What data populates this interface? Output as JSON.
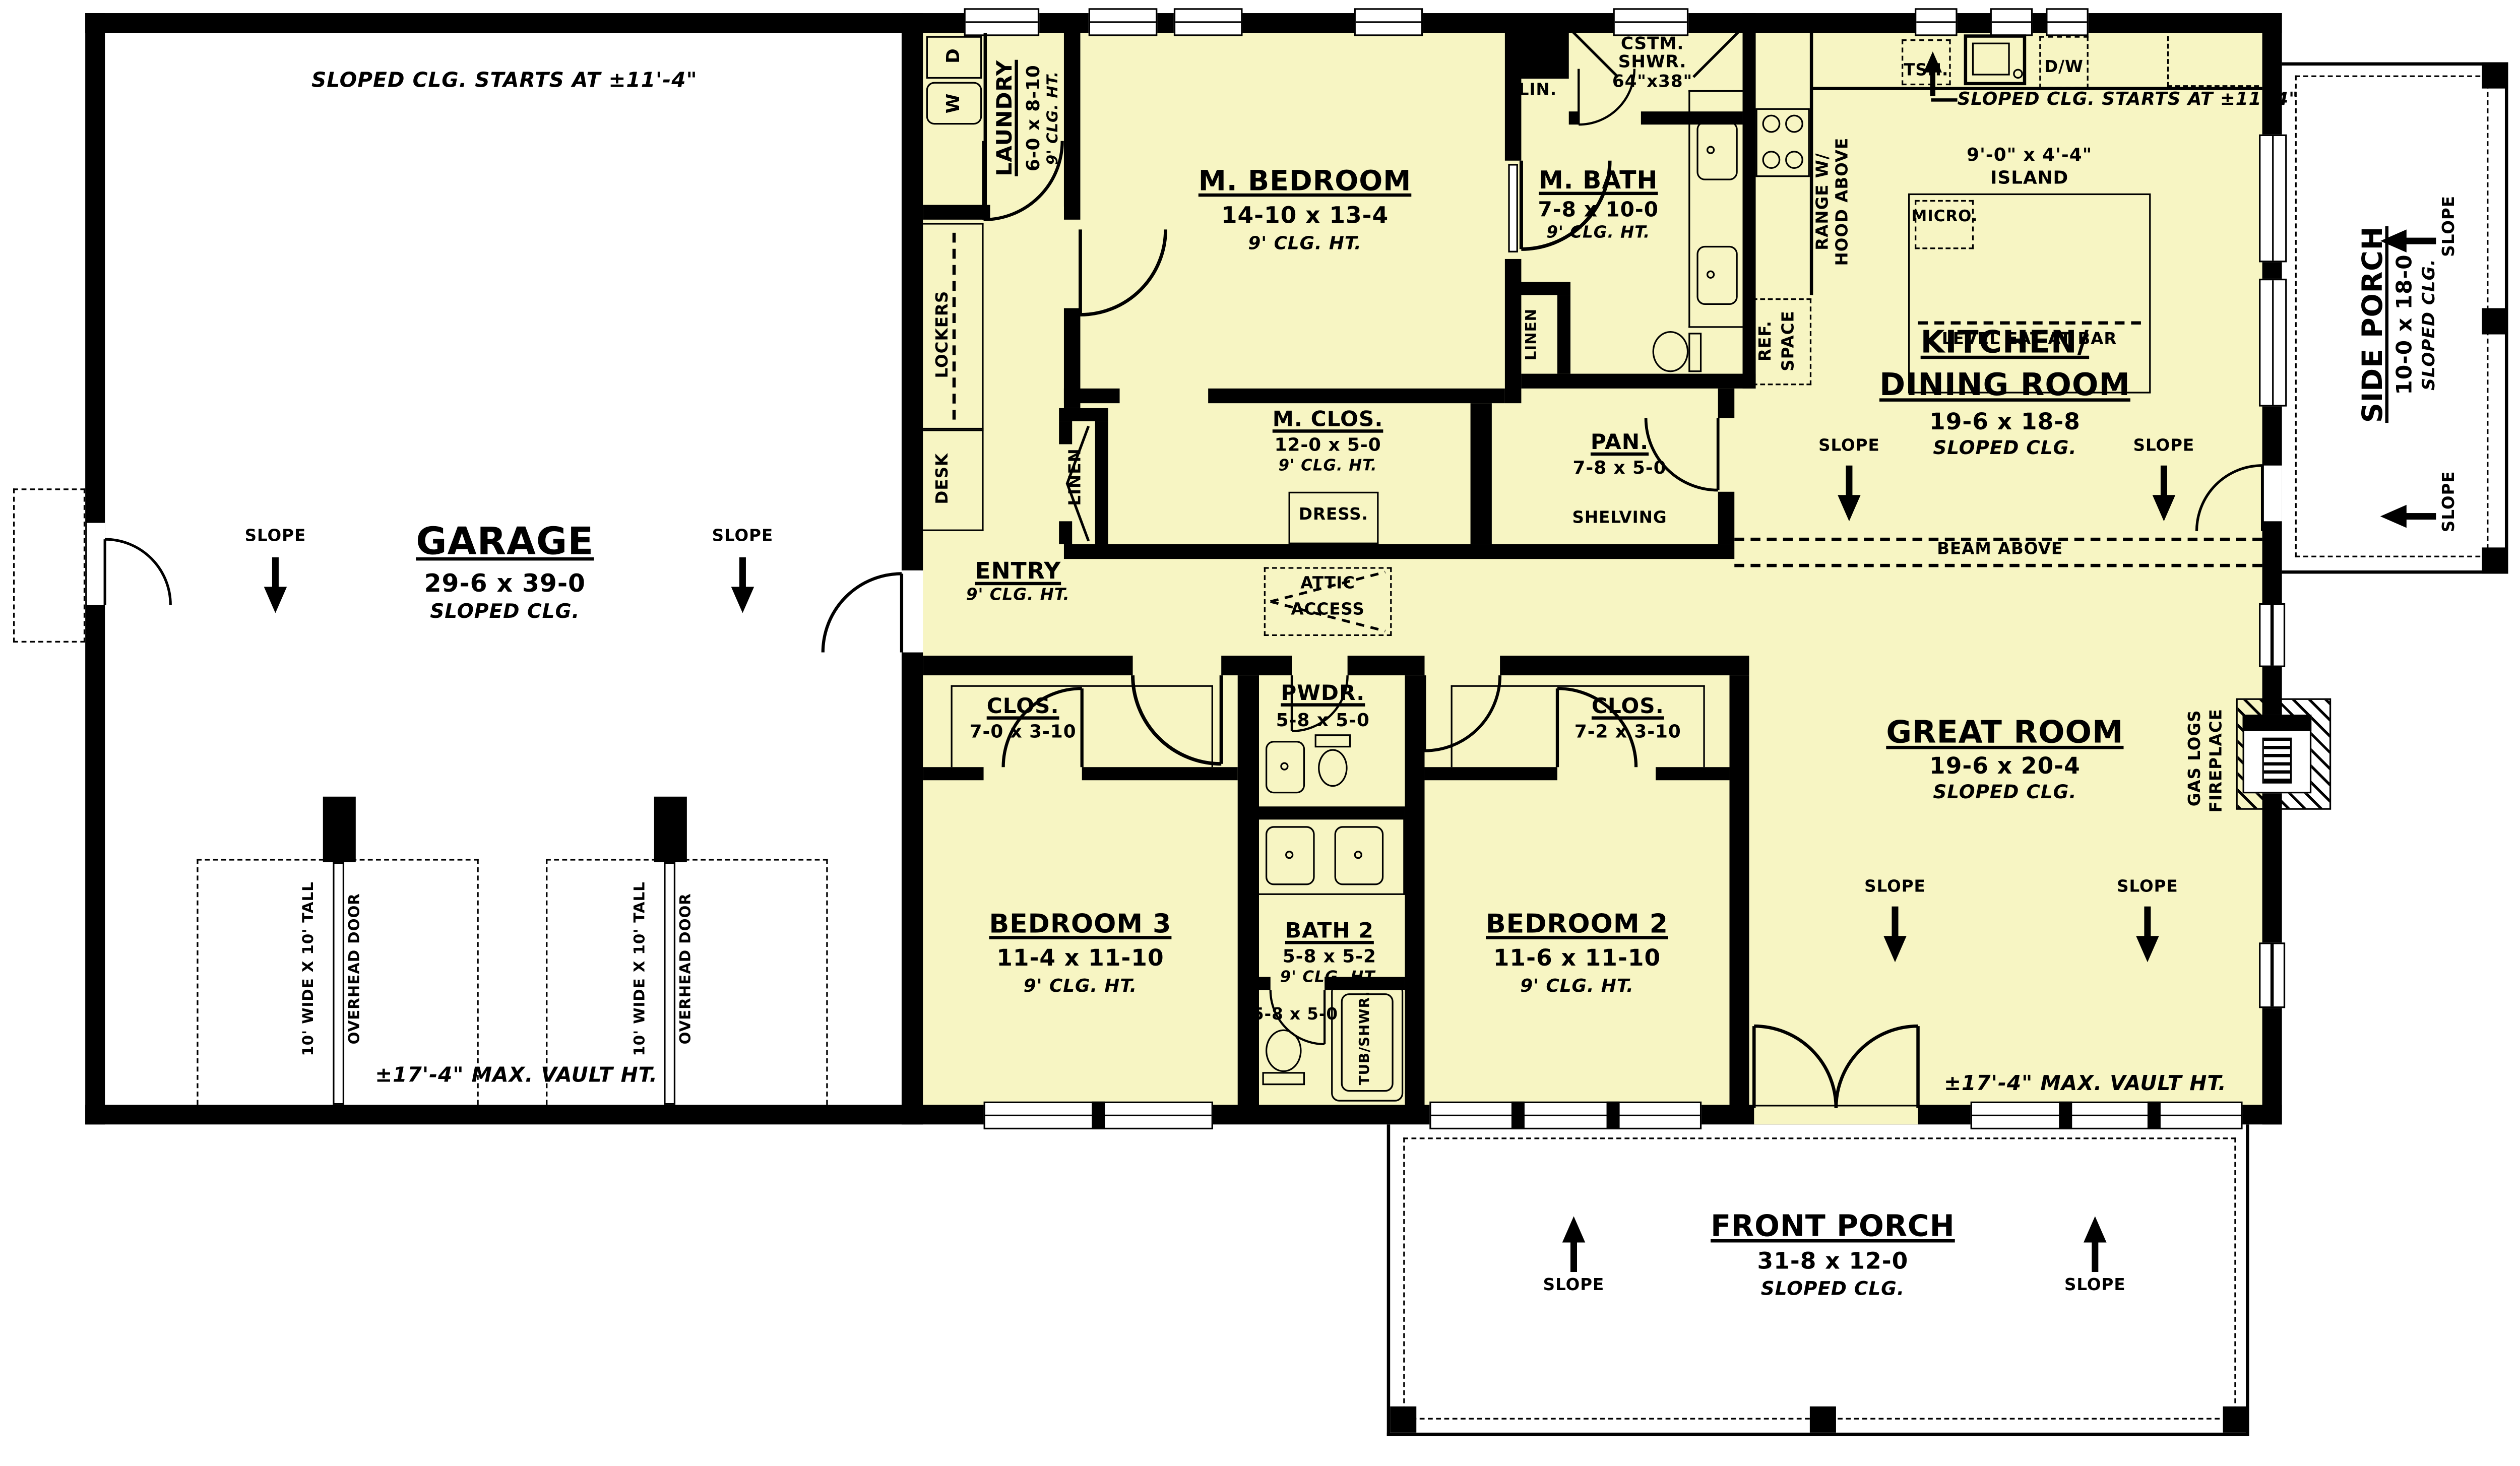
{
  "colors": {
    "floor": "#f7f5c3",
    "wall": "#000000",
    "background": "#ffffff"
  },
  "rooms": {
    "garage": {
      "name": "GARAGE",
      "dims": "29-6 x 39-0",
      "clg": "SLOPED CLG."
    },
    "laundry": {
      "name": "LAUNDRY",
      "dims": "6-0 x 8-10",
      "clg": "9' CLG. HT."
    },
    "m_bedroom": {
      "name": "M. BEDROOM",
      "dims": "14-10 x 13-4",
      "clg": "9' CLG. HT."
    },
    "m_bath": {
      "name": "M. BATH",
      "dims": "7-8 x 10-0",
      "clg": "9' CLG. HT."
    },
    "cstm_shwr": {
      "line1": "CSTM.",
      "line2": "SHWR.",
      "line3": "64\"x38\""
    },
    "lin": {
      "name": "LIN."
    },
    "linen_hall": {
      "name": "LINEN"
    },
    "linen_bath": {
      "name": "LINEN"
    },
    "m_clos": {
      "name": "M. CLOS.",
      "dims": "12-0 x 5-0",
      "clg": "9' CLG. HT."
    },
    "dress": {
      "name": "DRESS."
    },
    "pan": {
      "name": "PAN.",
      "dims": "7-8 x 5-0",
      "shelving": "SHELVING"
    },
    "entry": {
      "name": "ENTRY",
      "clg": "9' CLG. HT."
    },
    "kitchen": {
      "name1": "KITCHEN/",
      "name2": "DINING ROOM",
      "dims": "19-6 x 18-8",
      "clg": "SLOPED CLG."
    },
    "great": {
      "name": "GREAT ROOM",
      "dims": "19-6 x 20-4",
      "clg": "SLOPED CLG."
    },
    "clos_left": {
      "name": "CLOS.",
      "dims": "7-0 x 3-10"
    },
    "pwdr": {
      "name": "PWDR.",
      "dims": "5-8 x 5-0"
    },
    "clos_right": {
      "name": "CLOS.",
      "dims": "7-2 x 3-10"
    },
    "bedroom3": {
      "name": "BEDROOM 3",
      "dims": "11-4 x 11-10",
      "clg": "9' CLG. HT."
    },
    "bath2": {
      "name": "BATH 2",
      "dims": "5-8 x 5-2",
      "clg": "9' CLG. HT.",
      "wc_dims": "5-8 x 5-0",
      "tub": "TUB/SHWR."
    },
    "bedroom2": {
      "name": "BEDROOM 2",
      "dims": "11-6 x 11-10",
      "clg": "9' CLG. HT."
    },
    "side_porch": {
      "name": "SIDE PORCH",
      "dims": "10-0 x 18-0",
      "clg": "SLOPED CLG."
    },
    "front_porch": {
      "name": "FRONT PORCH",
      "dims": "31-8 x 12-0",
      "clg": "SLOPED CLG."
    }
  },
  "notes": {
    "slope": "SLOPE",
    "garage_sloped_start": "SLOPED CLG. STARTS AT ±11'-4\"",
    "kitchen_sloped_start": "SLOPED CLG. STARTS AT ±11'-4\"",
    "garage_vault": "±17'-4\" MAX. VAULT HT.",
    "great_vault": "±17'-4\" MAX. VAULT HT.",
    "beam": "BEAM ABOVE",
    "attic1": "ATTIC",
    "attic2": "ACCESS",
    "overhead_size": "10' WIDE X 10' TALL",
    "overhead_door": "OVERHEAD DOOR",
    "island_dims": "9'-0\" x 4'-4\"",
    "island": "ISLAND",
    "bar": "LEVEL EAT AT BAR",
    "micro": "MICRO.",
    "tsh": "TSH.",
    "dw": "D/W",
    "range1": "RANGE W/",
    "range2": "HOOD ABOVE",
    "ref1": "REF.",
    "ref2": "SPACE",
    "washer": "W",
    "dryer": "D",
    "lockers": "LOCKERS",
    "desk": "DESK",
    "fireplace1": "GAS LOGS",
    "fireplace2": "FIREPLACE"
  }
}
